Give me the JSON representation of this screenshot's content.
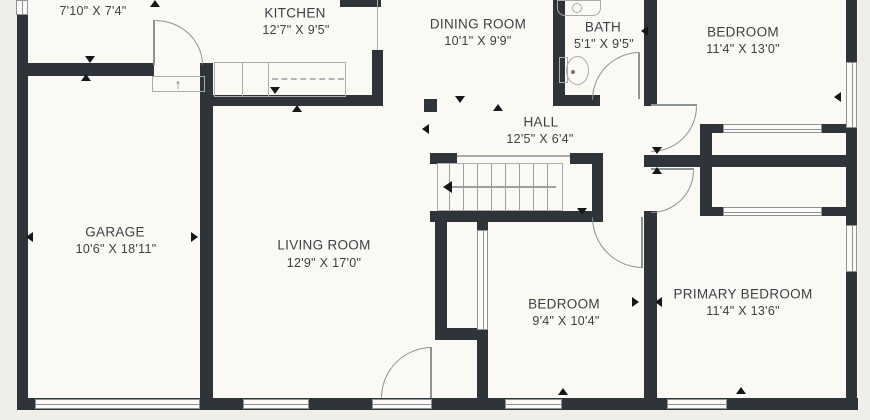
{
  "title": "Floor plan",
  "colors": {
    "wall": "#2f343a",
    "background": "#efeee8",
    "floor": "#faf9f4",
    "line": "#8d9296",
    "text": "#3c4147"
  },
  "rooms": [
    {
      "id": "upper-room",
      "name": "",
      "dimensions": "7'10\" X 7'4\""
    },
    {
      "id": "kitchen",
      "name": "KITCHEN",
      "dimensions": "12'7\" X 9'5\""
    },
    {
      "id": "dining-room",
      "name": "DINING ROOM",
      "dimensions": "10'1\" X 9'9\""
    },
    {
      "id": "bath",
      "name": "BATH",
      "dimensions": "5'1\" X 9'5\""
    },
    {
      "id": "bedroom-top",
      "name": "BEDROOM",
      "dimensions": "11'4\" X 13'0\""
    },
    {
      "id": "hall",
      "name": "HALL",
      "dimensions": "12'5\" X 6'4\""
    },
    {
      "id": "garage",
      "name": "GARAGE",
      "dimensions": "10'6\" X 18'11\""
    },
    {
      "id": "living-room",
      "name": "LIVING ROOM",
      "dimensions": "12'9\" X 17'0\""
    },
    {
      "id": "bedroom-bottom",
      "name": "BEDROOM",
      "dimensions": "9'4\" X 10'4\""
    },
    {
      "id": "primary-bedroom",
      "name": "PRIMARY BEDROOM",
      "dimensions": "11'4\" X 13'6\""
    }
  ],
  "fixtures": {
    "entry_step_arrow": "↑"
  }
}
